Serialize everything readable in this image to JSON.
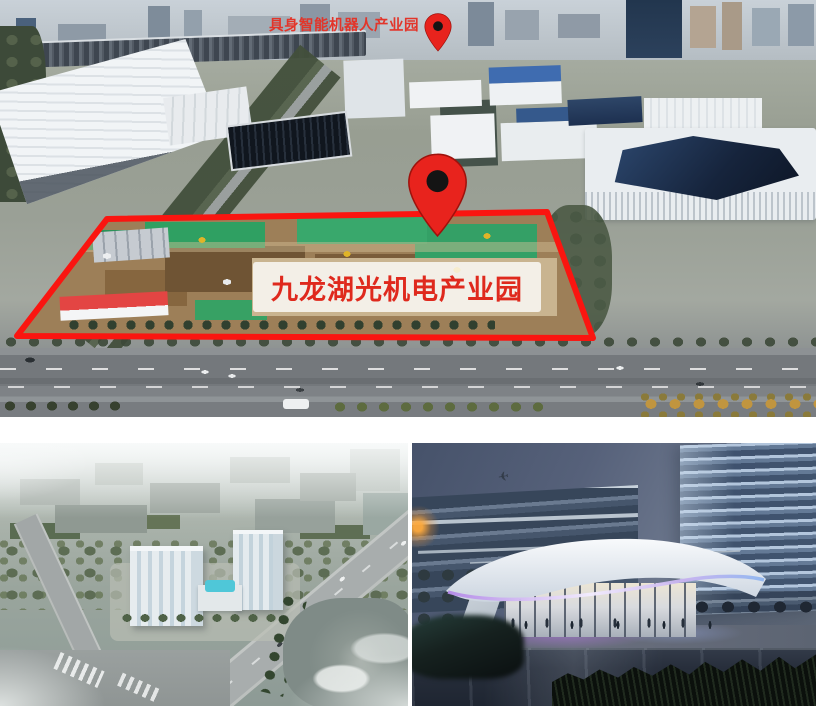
{
  "aerial_photo": {
    "secondary_label": "具身智能机器人产业园",
    "primary_label": "九龙湖光机电产业园"
  },
  "icons": {
    "pin_large": "map-pin",
    "pin_small": "map-pin",
    "plane_glyph": "✈"
  },
  "colors": {
    "outline_red": "#fa1510",
    "label_red": "#df291d",
    "secondary_label_red": "#e2352a",
    "pin_red": "#e8231d",
    "pin_dot_black": "#141414",
    "led_purple": "#bd8fe9",
    "pool_cyan": "#4fc7d8"
  }
}
